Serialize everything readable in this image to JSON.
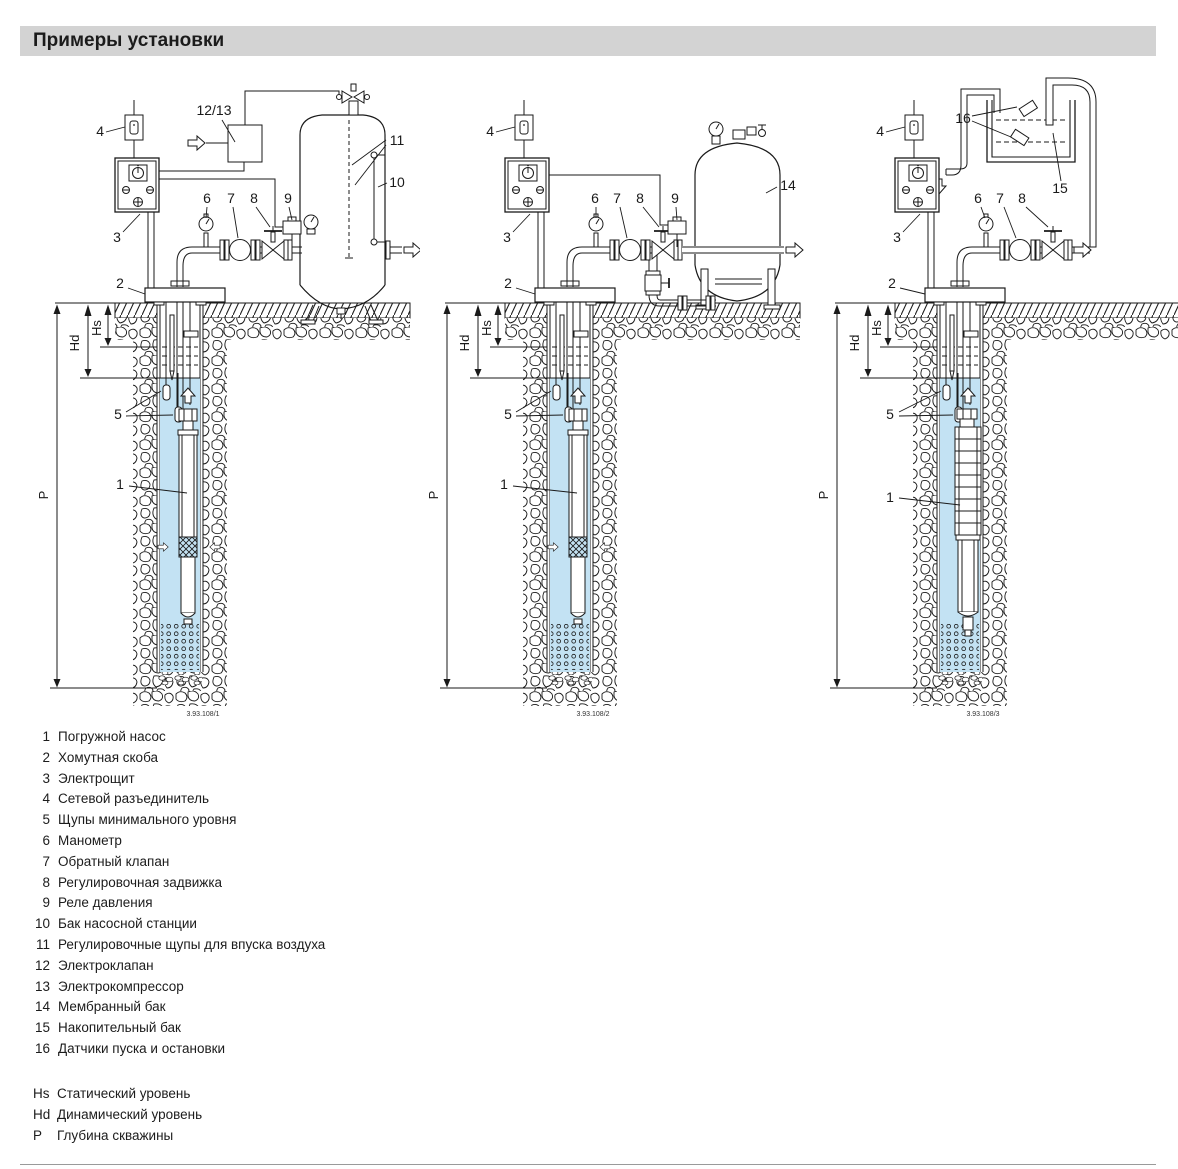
{
  "title": "Примеры установки",
  "colors": {
    "water": "#c3e2f3",
    "title_bg": "#d3d3d3",
    "line": "#1a1a1a"
  },
  "diagrams": [
    {
      "caption": "3.93.108/1",
      "labels": {
        "pump": "1",
        "clamp": "2",
        "panel": "3",
        "disconnect": "4",
        "probes": "5",
        "manometer": "6",
        "check_valve": "7",
        "gate_valve": "8",
        "pressure_switch": "9",
        "tank": "10",
        "air_probes": "11",
        "valve_compressor": "12/13"
      },
      "levels": {
        "static": "Hs",
        "dynamic": "Hd",
        "depth": "P"
      }
    },
    {
      "caption": "3.93.108/2",
      "labels": {
        "pump": "1",
        "clamp": "2",
        "panel": "3",
        "disconnect": "4",
        "probes": "5",
        "manometer": "6",
        "check_valve": "7",
        "gate_valve": "8",
        "pressure_switch": "9",
        "tank": "14"
      },
      "levels": {
        "static": "Hs",
        "dynamic": "Hd",
        "depth": "P"
      }
    },
    {
      "caption": "3.93.108/3",
      "labels": {
        "pump": "1",
        "clamp": "2",
        "panel": "3",
        "disconnect": "4",
        "probes": "5",
        "manometer": "6",
        "check_valve": "7",
        "gate_valve": "8",
        "sensors": "16",
        "tank": "15"
      },
      "levels": {
        "static": "Hs",
        "dynamic": "Hd",
        "depth": "P"
      }
    }
  ],
  "legend": [
    {
      "num": "1",
      "text": "Погружной насос"
    },
    {
      "num": "2",
      "text": "Хомутная скоба"
    },
    {
      "num": "3",
      "text": "Электрощит"
    },
    {
      "num": "4",
      "text": "Сетевой разъединитель"
    },
    {
      "num": "5",
      "text": "Щупы минимального уровня"
    },
    {
      "num": "6",
      "text": "Манометр"
    },
    {
      "num": "7",
      "text": "Обратный клапан"
    },
    {
      "num": "8",
      "text": "Регулировочная задвижка"
    },
    {
      "num": "9",
      "text": "Реле давления"
    },
    {
      "num": "10",
      "text": "Бак насосной станции"
    },
    {
      "num": "11",
      "text": "Регулировочные щупы для впуска воздуха"
    },
    {
      "num": "12",
      "text": "Электроклапан"
    },
    {
      "num": "13",
      "text": "Электрокомпрессор"
    },
    {
      "num": "14",
      "text": "Мембранный бак"
    },
    {
      "num": "15",
      "text": "Накопительный бак"
    },
    {
      "num": "16",
      "text": "Датчики пуска и остановки"
    }
  ],
  "abbreviations": [
    {
      "key": "Hs",
      "text": "Статический уровень"
    },
    {
      "key": "Hd",
      "text": "Динамический уровень"
    },
    {
      "key": "P",
      "text": "Глубина скважины"
    }
  ]
}
